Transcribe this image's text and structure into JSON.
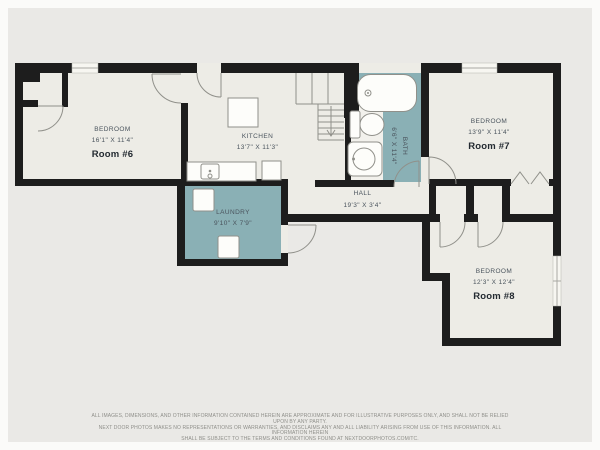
{
  "rooms": {
    "room6": {
      "name": "BEDROOM",
      "dims": "16'1\" X 11'4\"",
      "label": "Room #6"
    },
    "kitchen": {
      "name": "KITCHEN",
      "dims": "13'7\" X 11'3\""
    },
    "bath": {
      "name": "BATH",
      "dims": "6'6\" X 11'4\""
    },
    "hall": {
      "name": "HALL",
      "dims": "19'3\" X 3'4\""
    },
    "laundry": {
      "name": "LAUNDRY",
      "dims": "9'10\" X 7'9\""
    },
    "room7": {
      "name": "BEDROOM",
      "dims": "13'9\" X 11'4\"",
      "label": "Room #7"
    },
    "room8": {
      "name": "BEDROOM",
      "dims": "12'3\" X 12'4\"",
      "label": "Room #8"
    }
  },
  "colors": {
    "background": "#eae9e6",
    "floor": "#edece6",
    "wall": "#1d1d1d",
    "accent": "#8ab0b5",
    "line": "#90908a",
    "text": "#4a545d",
    "text_bold": "#232a31",
    "muted": "#8f8f8a"
  },
  "icons": [
    "bathtub-icon",
    "toilet-icon",
    "sink-icon",
    "kitchen-sink-icon",
    "stove-icon",
    "island-icon",
    "washer-icon",
    "dryer-icon",
    "stairs-icon",
    "door-arc-icon",
    "window-icon",
    "bifold-door-icon"
  ],
  "disclaimer": {
    "line1": "ALL IMAGES, DIMENSIONS, AND OTHER INFORMATION CONTAINED HEREIN ARE APPROXIMATE AND FOR ILLUSTRATIVE PURPOSES ONLY, AND SHALL NOT BE RELIED UPON BY ANY PARTY.",
    "line2": "NEXT DOOR PHOTOS MAKES NO REPRESENTATIONS OR WARRANTIES, AND DISCLAIMS ANY AND ALL LIABILITY ARISING FROM USE OF THIS INFORMATION. ALL INFORMATION HEREIN",
    "line3": "SHALL BE SUBJECT TO THE TERMS AND CONDITIONS FOUND AT NEXTDOORPHOTOS.COM/TC."
  }
}
